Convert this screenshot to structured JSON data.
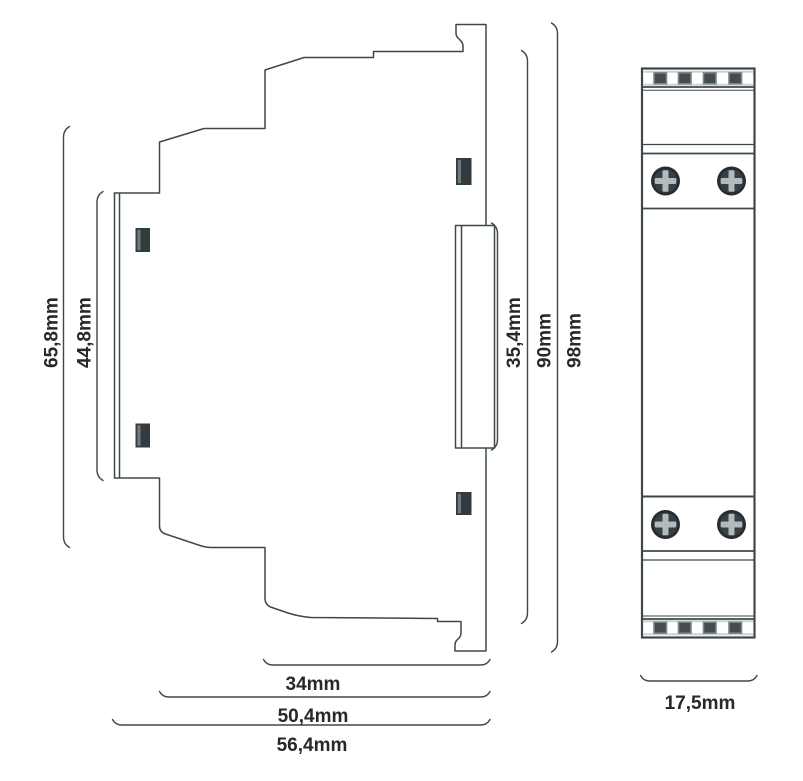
{
  "diagram": {
    "kind": "technical-dimension-drawing",
    "unit": "mm"
  },
  "dimensions": {
    "rear_section_height": "65,8mm",
    "din_area_height": "44,8mm",
    "front_face_height": "35,4mm",
    "body_height": "90mm",
    "total_height": "98mm",
    "front_depth": "34mm",
    "mid_depth": "50,4mm",
    "total_depth": "56,4mm",
    "module_width": "17,5mm"
  },
  "colors": {
    "line": "#3d484c",
    "text": "#26292b",
    "clip": "#343b3f",
    "clip_highlight": "#717b7e",
    "terminal_fill": "#444c50",
    "terminal_border": "#7d8689",
    "band_strip": "#ccd2d2",
    "screw_body": "#262c30",
    "screw_inner": "#373f43",
    "screw_cross": "#b2babd",
    "background": "#ffffff"
  }
}
